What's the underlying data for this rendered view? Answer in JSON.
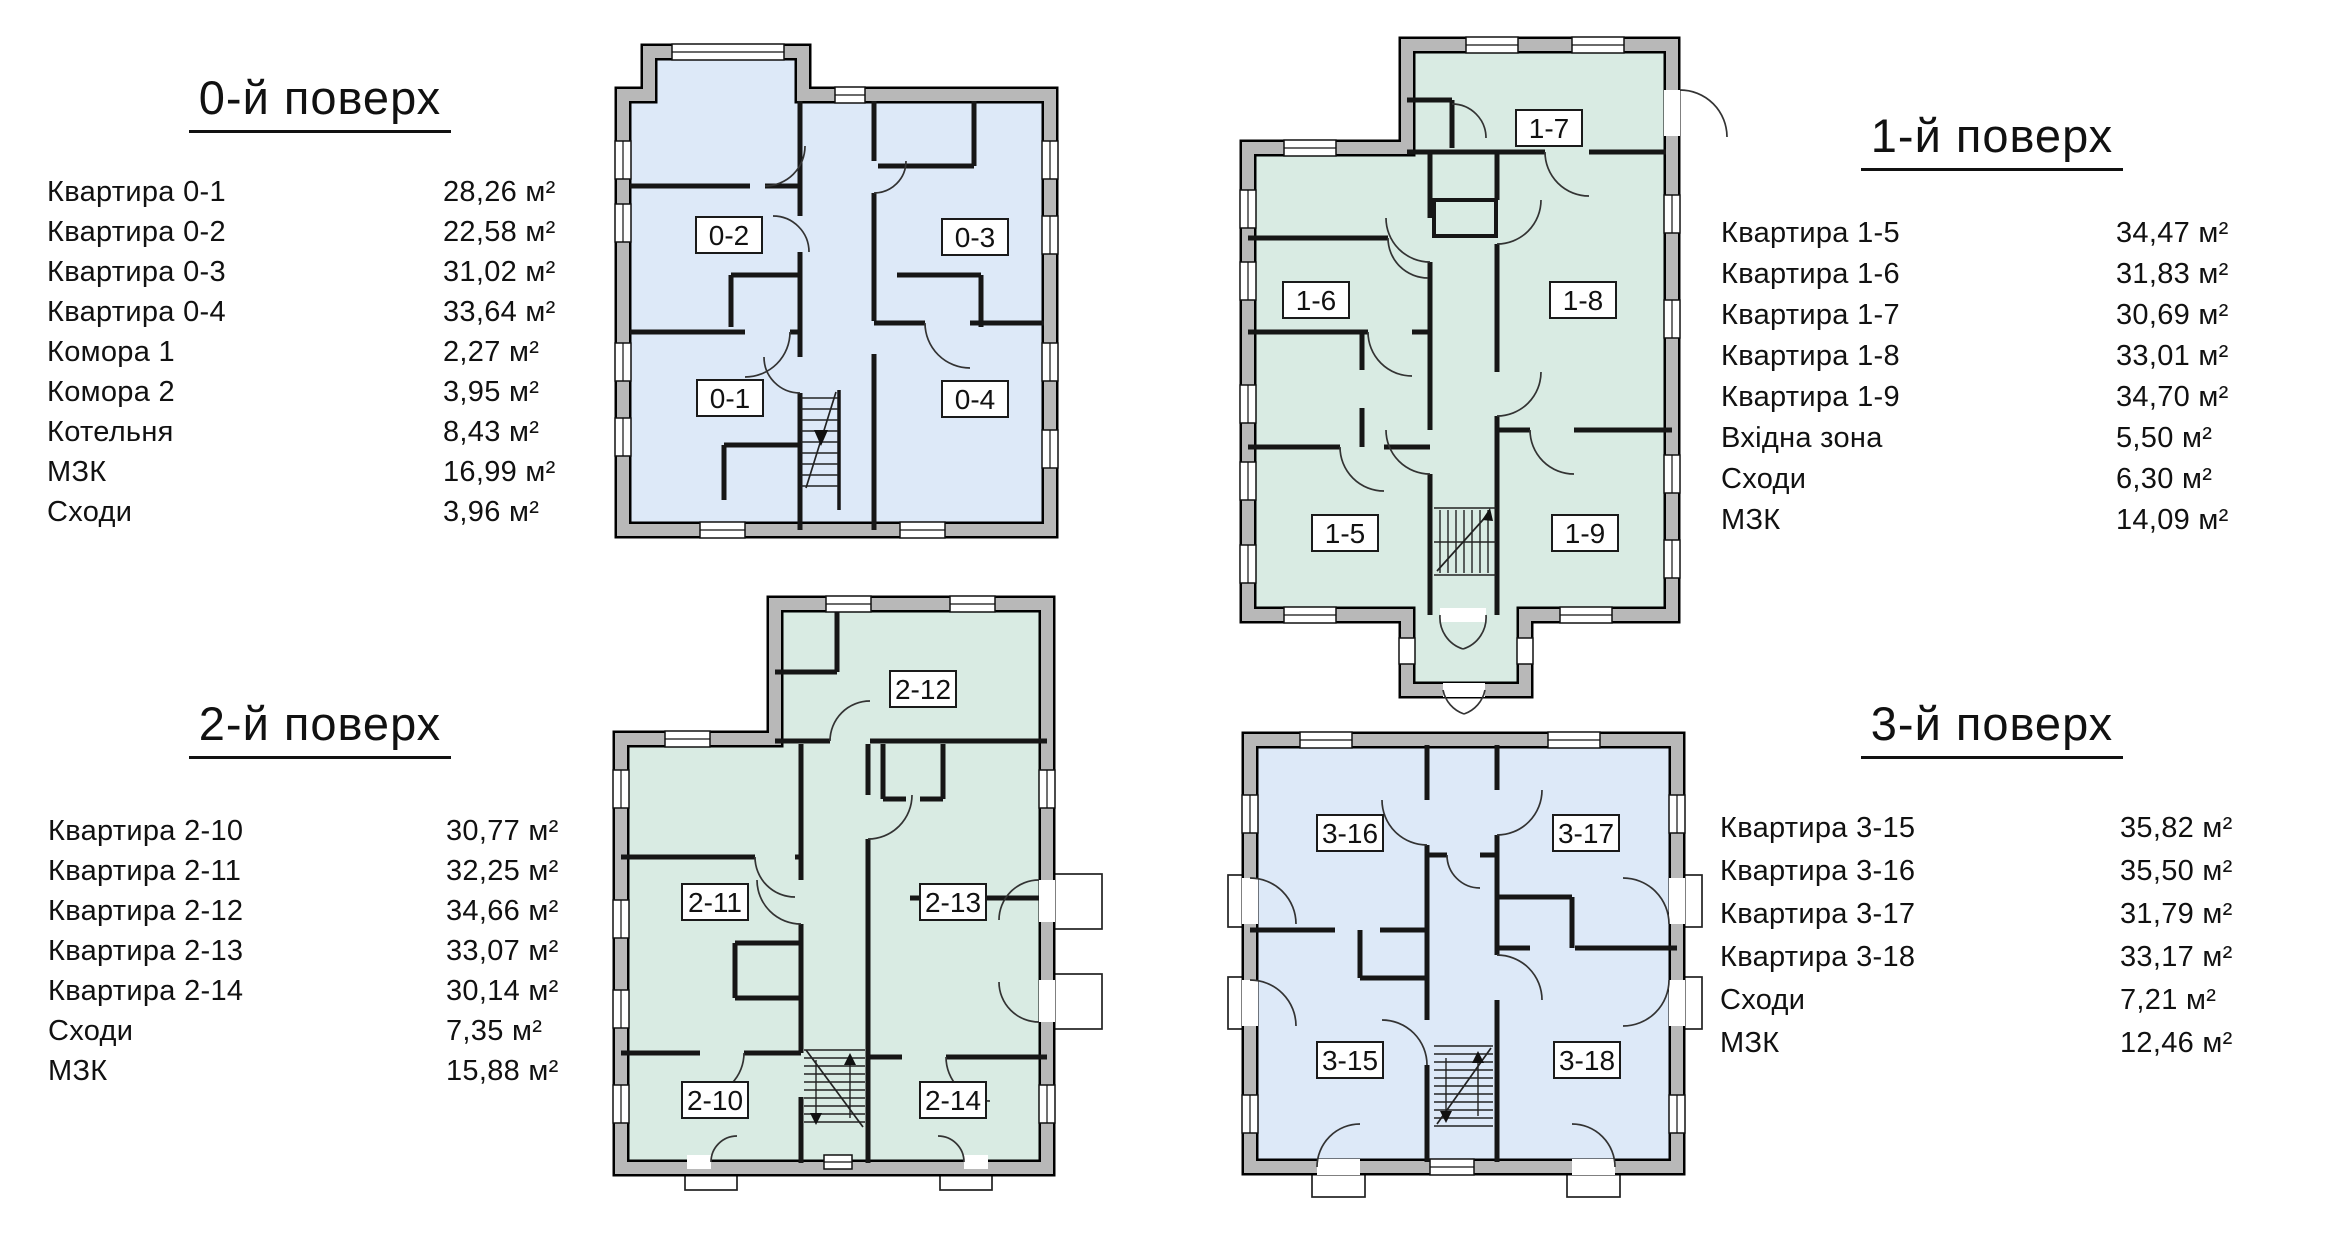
{
  "colors": {
    "blue": "#dde9f8",
    "green": "#d9ebe3",
    "wall": "#b8b8b8",
    "ink": "#111111"
  },
  "floors": [
    {
      "title": "0-й поверх",
      "rows": [
        {
          "label": "Квартира 0-1",
          "area": "28,26 м²"
        },
        {
          "label": "Квартира 0-2",
          "area": "22,58 м²"
        },
        {
          "label": "Квартира 0-3",
          "area": "31,02 м²"
        },
        {
          "label": "Квартира 0-4",
          "area": "33,64 м²"
        },
        {
          "label": "Комора 1",
          "area": "2,27 м²"
        },
        {
          "label": "Комора 2",
          "area": "3,95 м²"
        },
        {
          "label": "Котельня",
          "area": "8,43 м²"
        },
        {
          "label": "МЗК",
          "area": "16,99 м²"
        },
        {
          "label": "Сходи",
          "area": "3,96 м²"
        }
      ],
      "plan_labels": [
        "0-2",
        "0-3",
        "0-1",
        "0-4"
      ]
    },
    {
      "title": "1-й поверх",
      "rows": [
        {
          "label": "Квартира 1-5",
          "area": "34,47 м²"
        },
        {
          "label": "Квартира 1-6",
          "area": "31,83 м²"
        },
        {
          "label": "Квартира 1-7",
          "area": "30,69 м²"
        },
        {
          "label": "Квартира 1-8",
          "area": "33,01 м²"
        },
        {
          "label": "Квартира 1-9",
          "area": "34,70 м²"
        },
        {
          "label": "Вхідна зона",
          "area": "5,50 м²"
        },
        {
          "label": "Сходи",
          "area": "6,30 м²"
        },
        {
          "label": "МЗК",
          "area": "14,09 м²"
        }
      ],
      "plan_labels": [
        "1-7",
        "1-6",
        "1-8",
        "1-5",
        "1-9"
      ]
    },
    {
      "title": "2-й поверх",
      "rows": [
        {
          "label": "Квартира 2-10",
          "area": "30,77 м²"
        },
        {
          "label": "Квартира 2-11",
          "area": "32,25 м²"
        },
        {
          "label": "Квартира 2-12",
          "area": "34,66 м²"
        },
        {
          "label": "Квартира 2-13",
          "area": "33,07 м²"
        },
        {
          "label": "Квартира 2-14",
          "area": "30,14 м²"
        },
        {
          "label": "Сходи",
          "area": "7,35 м²"
        },
        {
          "label": "МЗК",
          "area": "15,88 м²"
        }
      ],
      "plan_labels": [
        "2-12",
        "2-11",
        "2-13",
        "2-10",
        "2-14"
      ]
    },
    {
      "title": "3-й поверх",
      "rows": [
        {
          "label": "Квартира 3-15",
          "area": "35,82 м²"
        },
        {
          "label": "Квартира 3-16",
          "area": "35,50 м²"
        },
        {
          "label": "Квартира 3-17",
          "area": "31,79 м²"
        },
        {
          "label": "Квартира 3-18",
          "area": "33,17 м²"
        },
        {
          "label": "Сходи",
          "area": "7,21 м²"
        },
        {
          "label": "МЗК",
          "area": "12,46 м²"
        }
      ],
      "plan_labels": [
        "3-16",
        "3-17",
        "3-15",
        "3-18"
      ]
    }
  ]
}
